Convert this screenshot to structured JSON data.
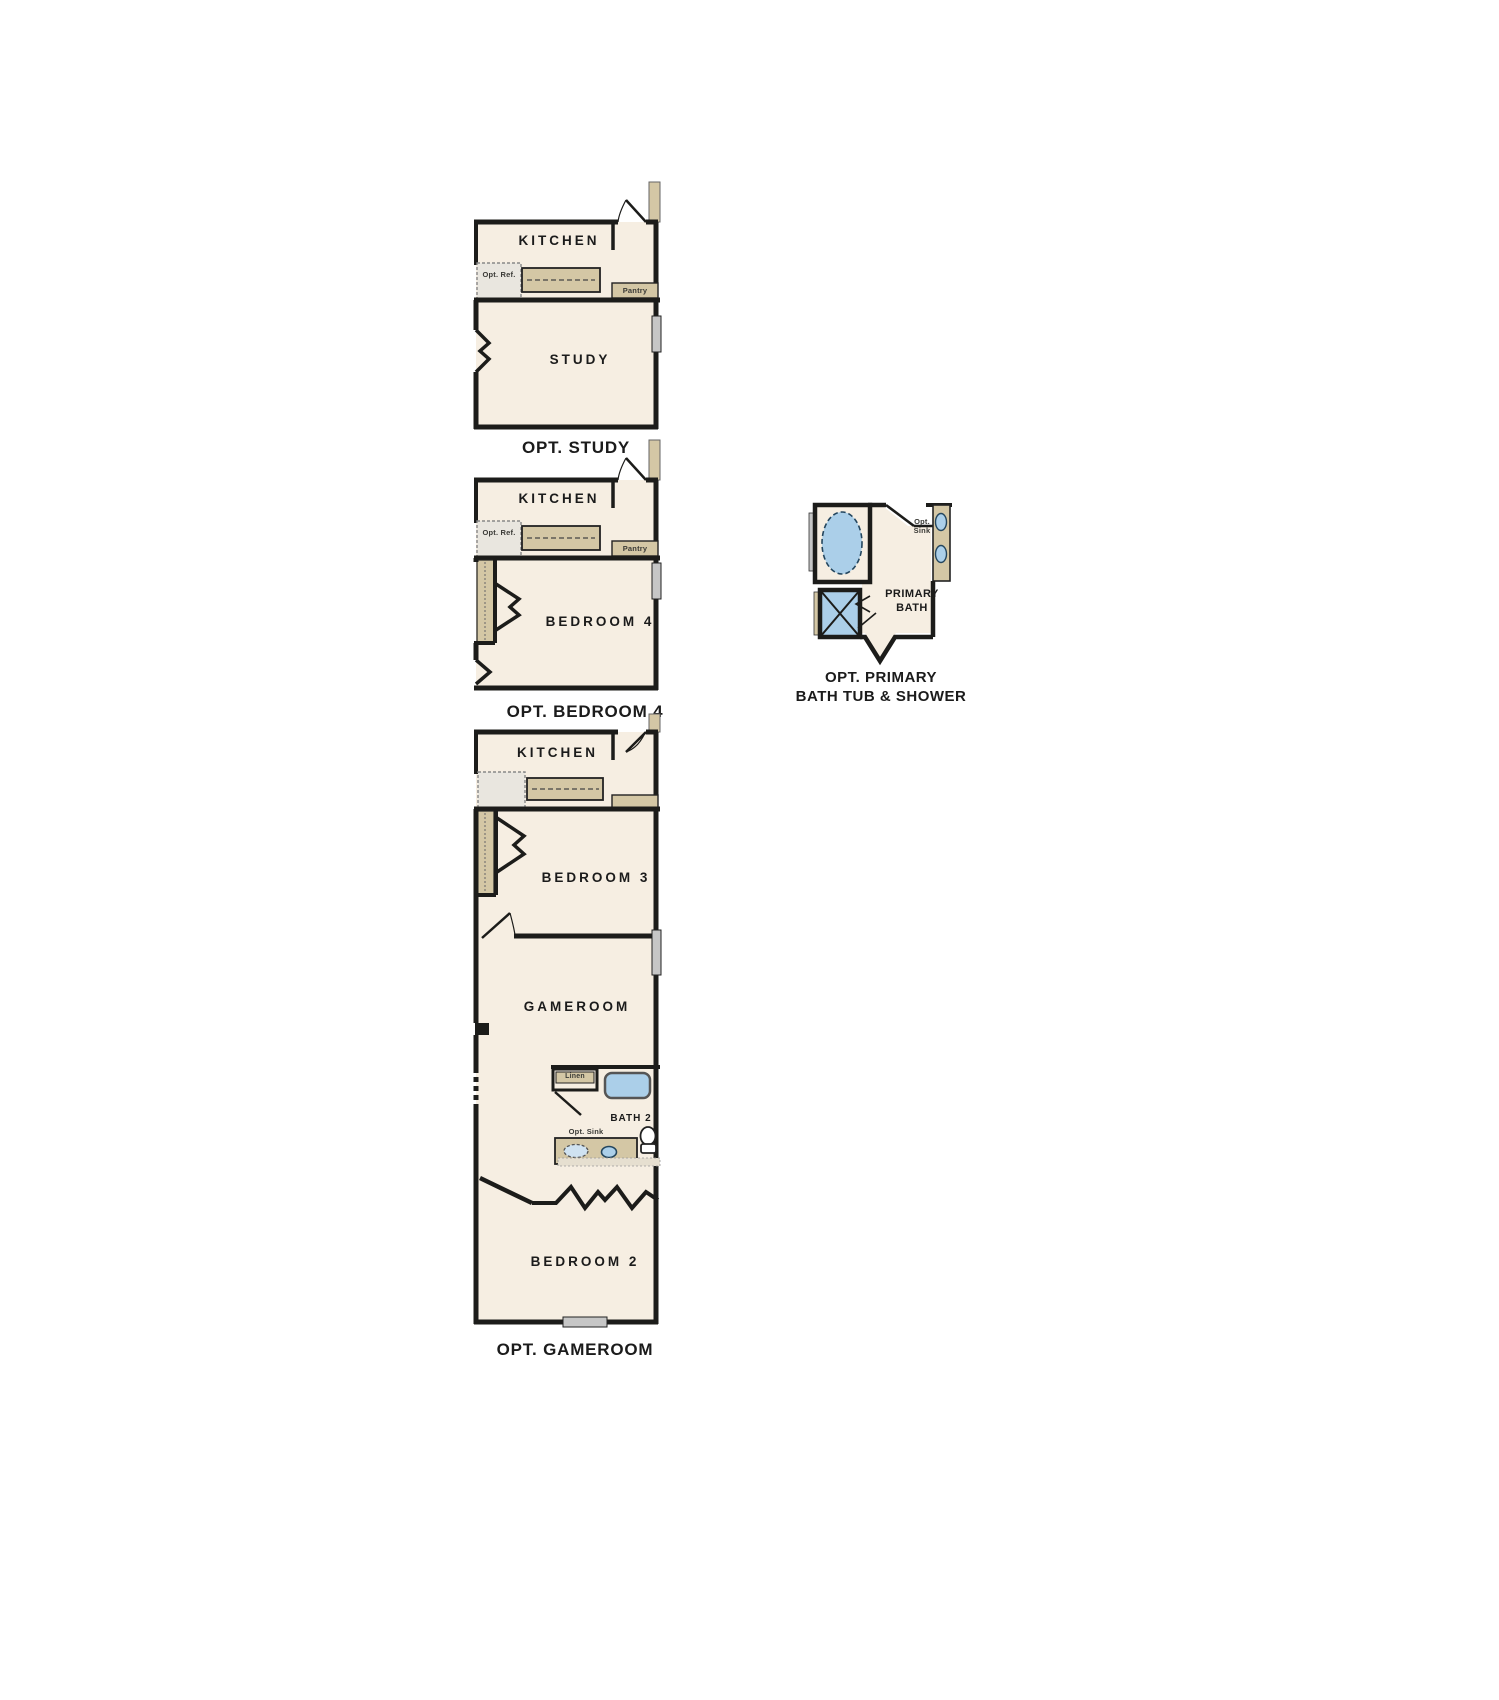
{
  "document": {
    "background": "#ffffff",
    "kind": "floor-plan-options-sheet"
  },
  "colors": {
    "wall": "#1c1c1a",
    "floor": "#f6eee2",
    "cabinet_tan": "#d4c7a5",
    "fixture_blue": "#abcfe9",
    "fixture_blue_light": "#cfe2f1",
    "window_gray": "#c6c6c6",
    "ref_gray": "#e9e6df",
    "text": "#1b1b1b"
  },
  "plans": {
    "opt_study": {
      "caption": "OPT. STUDY",
      "labels": {
        "kitchen": "KITCHEN",
        "study": "STUDY",
        "opt_ref": "Opt. Ref.",
        "pantry": "Pantry"
      }
    },
    "opt_bedroom4": {
      "caption": "OPT. BEDROOM 4",
      "labels": {
        "kitchen": "KITCHEN",
        "bedroom4": "BEDROOM 4",
        "opt_ref": "Opt. Ref.",
        "pantry": "Pantry"
      }
    },
    "opt_primary_bath": {
      "caption_line1": "OPT. PRIMARY",
      "caption_line2": "BATH TUB & SHOWER",
      "labels": {
        "primary_bath": "PRIMARY BATH",
        "opt_sink": "Opt. Sink"
      }
    },
    "opt_gameroom": {
      "caption": "OPT. GAMEROOM",
      "labels": {
        "kitchen": "KITCHEN",
        "bedroom3": "BEDROOM 3",
        "gameroom": "GAMEROOM",
        "bath2": "BATH 2",
        "opt_sink": "Opt. Sink",
        "linen": "Linen",
        "bedroom2": "BEDROOM 2"
      }
    }
  }
}
